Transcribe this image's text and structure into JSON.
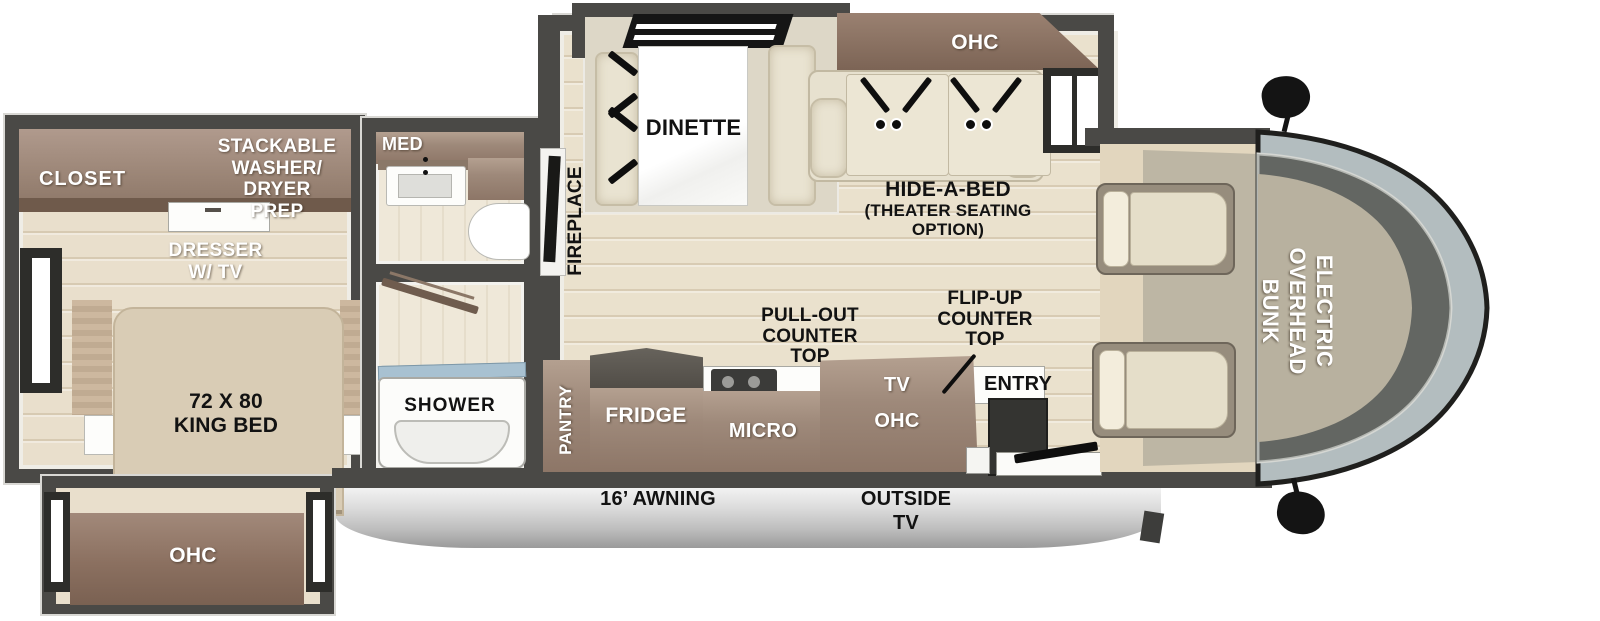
{
  "colors": {
    "wall": "#4a4946",
    "floor": "#eae1cd",
    "cabinet": "#a08a7b",
    "cabinet_dark": "#8a7263",
    "fabric": "#e9e3d1",
    "windshield_glass": "#b3bdbf",
    "shower_glass": "#a8c1d1",
    "awning_silver": "#cccccc"
  },
  "bedroom": {
    "closet": "CLOSET",
    "washer_dryer": "STACKABLE\nWASHER/\nDRYER\nPREP",
    "dresser": "DRESSER\nW/ TV",
    "king_bed": "72 X 80\nKING BED",
    "ohc": "OHC"
  },
  "bathroom": {
    "med": "MED",
    "shower": "SHOWER"
  },
  "living": {
    "dinette": "DINETTE",
    "fireplace": "FIREPLACE",
    "ohc": "OHC",
    "hide_a_bed": "HIDE-A-BED",
    "hide_a_bed_sub": "(THEATER SEATING\nOPTION)"
  },
  "kitchen": {
    "pantry": "PANTRY",
    "fridge": "FRIDGE",
    "micro": "MICRO",
    "tv": "TV",
    "tv_ohc": "OHC",
    "pull_out": "PULL-OUT\nCOUNTER\nTOP",
    "flip_up": "FLIP-UP\nCOUNTER\nTOP",
    "entry": "ENTRY"
  },
  "cab": {
    "bunk": "ELECTRIC\nOVERHEAD\nBUNK"
  },
  "exterior": {
    "awning": "16’ AWNING",
    "outside_tv": "OUTSIDE\nTV"
  }
}
